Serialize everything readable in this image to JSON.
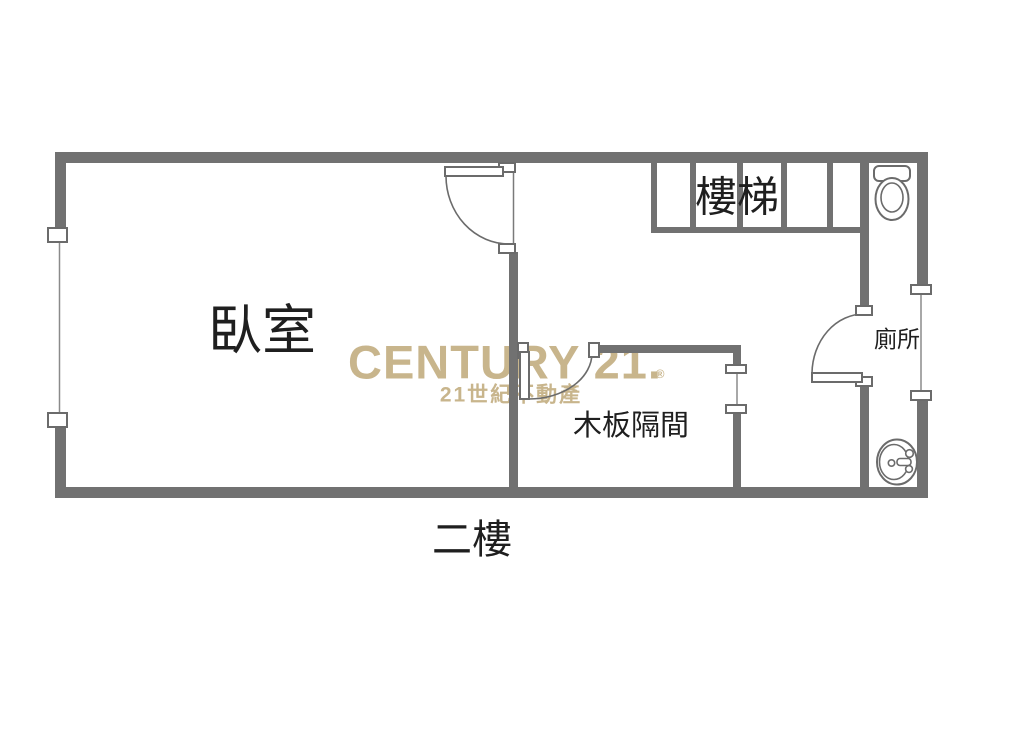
{
  "colors": {
    "background": "#ffffff",
    "wall": "#717171",
    "line": "#6b6b6b",
    "label_text": "#1f1f1f",
    "watermark": "#c8b58c"
  },
  "watermark": {
    "wordmark": "CENTURY 21.",
    "registered_mark": "®",
    "subtitle": "21世紀不動產"
  },
  "floor_label": "二樓",
  "rooms": [
    {
      "id": "bedroom",
      "label": "臥室"
    },
    {
      "id": "stairs",
      "label": "樓梯"
    },
    {
      "id": "toilet",
      "label": "廁所"
    },
    {
      "id": "wood-partition",
      "label": "木板隔間"
    }
  ],
  "icons": {
    "toilet": "toilet-icon",
    "sink": "sink-icon"
  }
}
